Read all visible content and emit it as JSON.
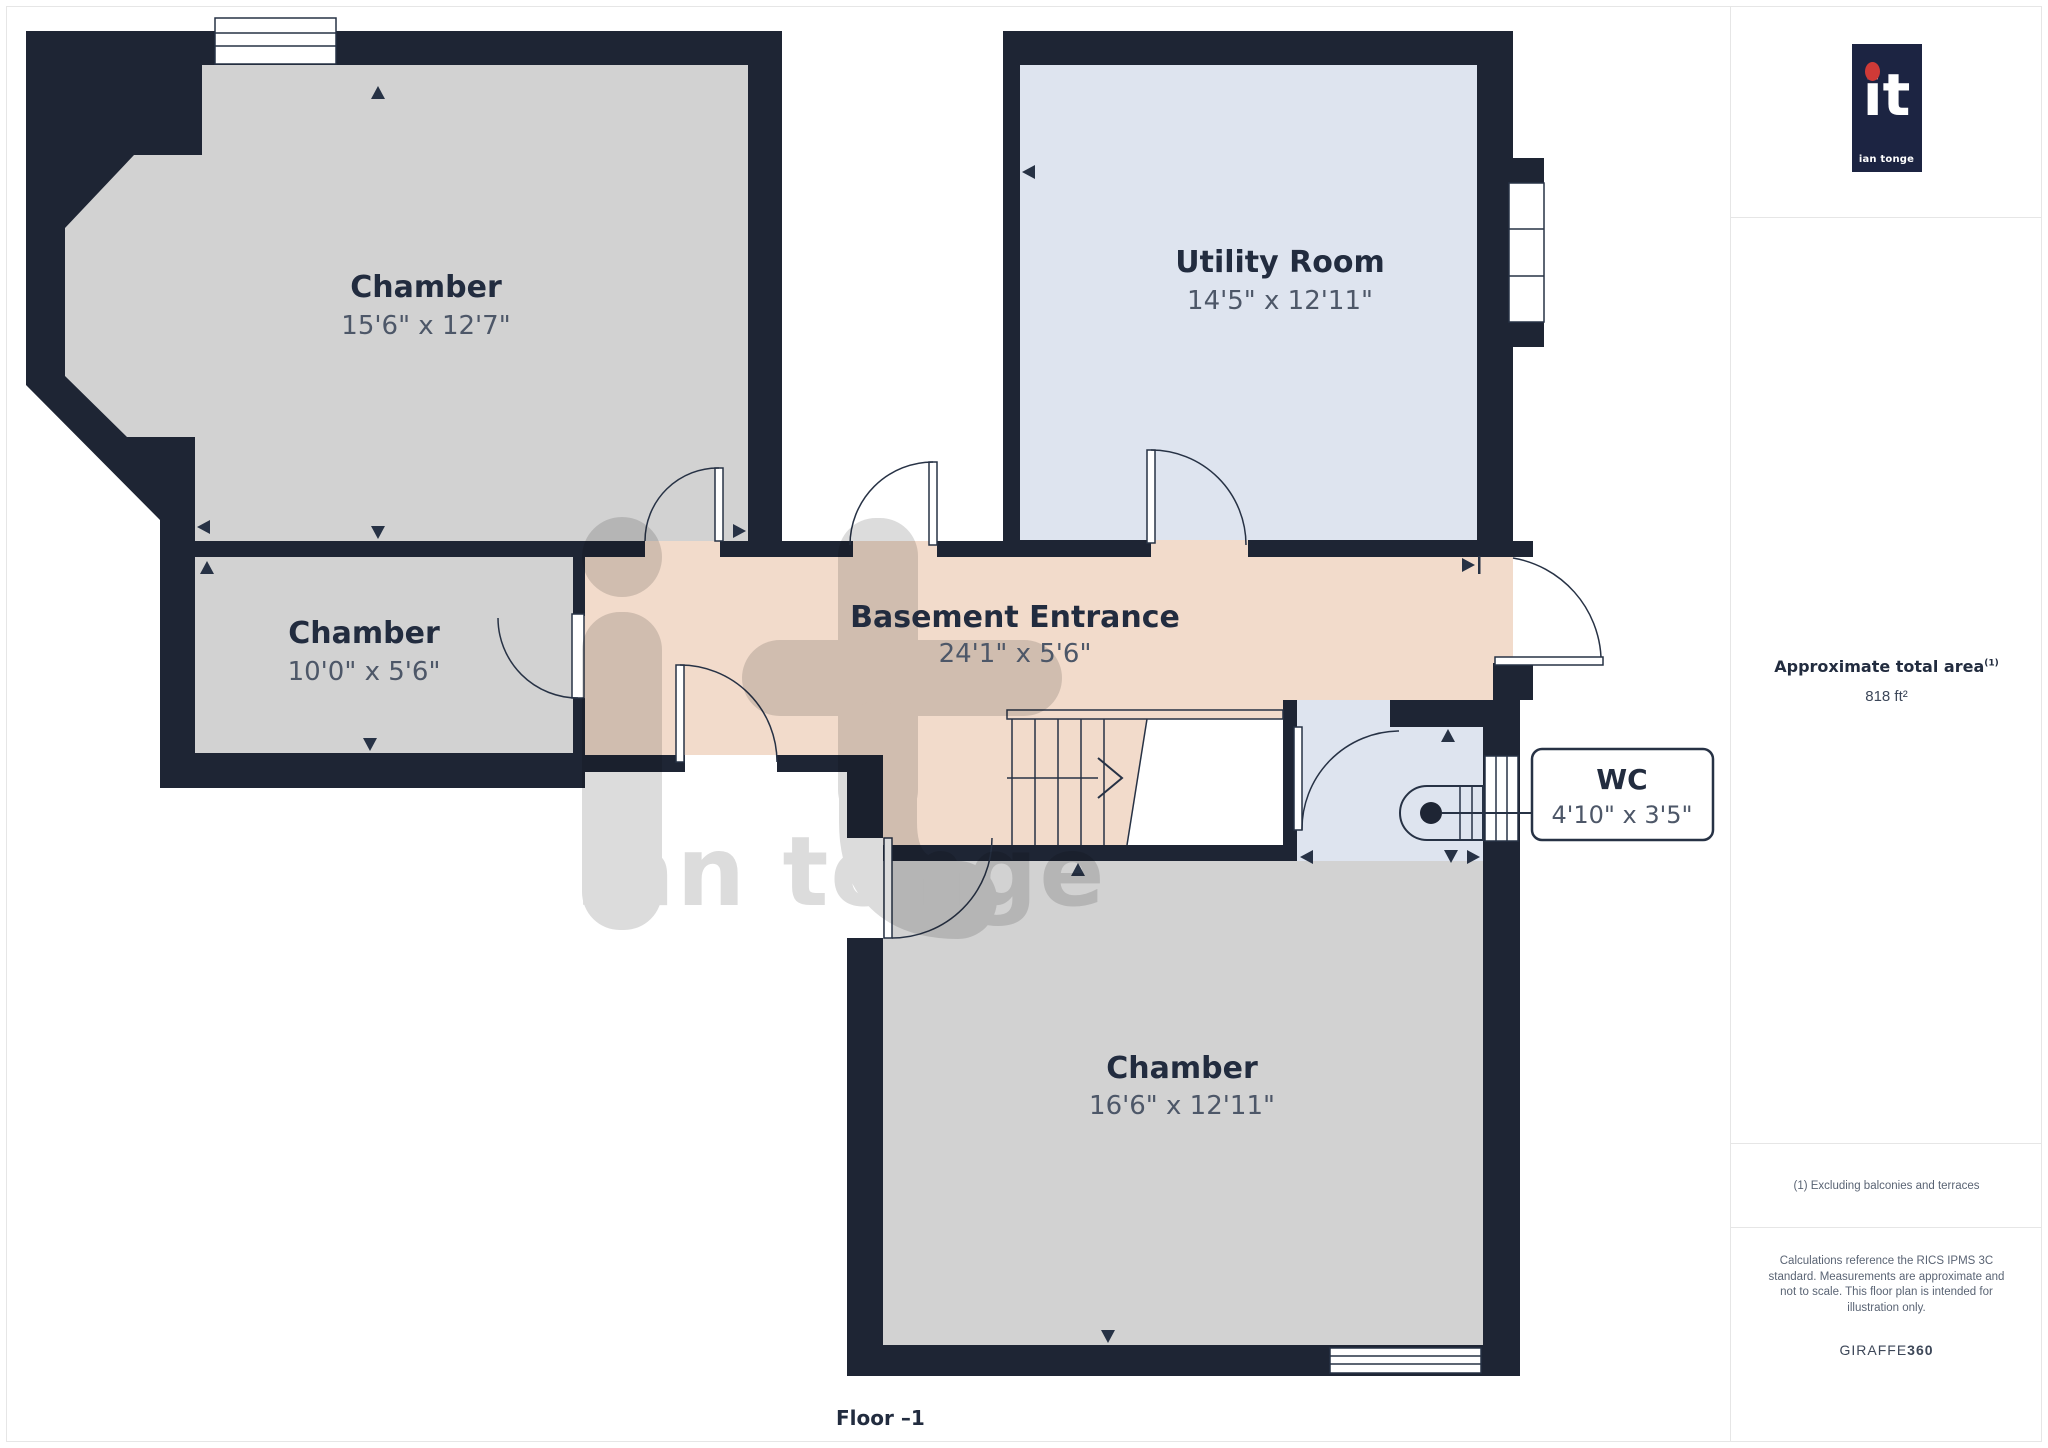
{
  "plan": {
    "rooms": [
      {
        "name": "Chamber",
        "dims": "15'6\" x 12'7\""
      },
      {
        "name": "Chamber",
        "dims": "10'0\" x 5'6\""
      },
      {
        "name": "Utility Room",
        "dims": "14'5\" x 12'11\""
      },
      {
        "name": "Basement Entrance",
        "dims": "24'1\" x 5'6\""
      },
      {
        "name": "WC",
        "dims": "4'10\" x 3'5\""
      },
      {
        "name": "Chamber",
        "dims": "16'6\" x 12'11\""
      }
    ],
    "floor_label": "Floor –1",
    "watermark": {
      "mark": "it",
      "name": "ian tonge"
    },
    "colors": {
      "wall": "#1e2534",
      "room_gray": "#d2d2d2",
      "room_blue": "#dee4ef",
      "room_peach": "#f2dbcb",
      "accent_text": "#222c3f",
      "dims_text": "#4d5768"
    }
  },
  "sidebar": {
    "logo": {
      "mark": "it",
      "subtext": "ian tonge"
    },
    "area": {
      "title": "Approximate total area",
      "superscript": "(1)",
      "value": "818 ft²"
    },
    "footnote": "(1) Excluding balconies and terraces",
    "disclaimer": "Calculations reference the RICS IPMS 3C standard. Measurements are approximate and not to scale. This floor plan is intended for illustration only.",
    "brand": {
      "name": "GIRAFFE",
      "suffix": "360"
    }
  }
}
